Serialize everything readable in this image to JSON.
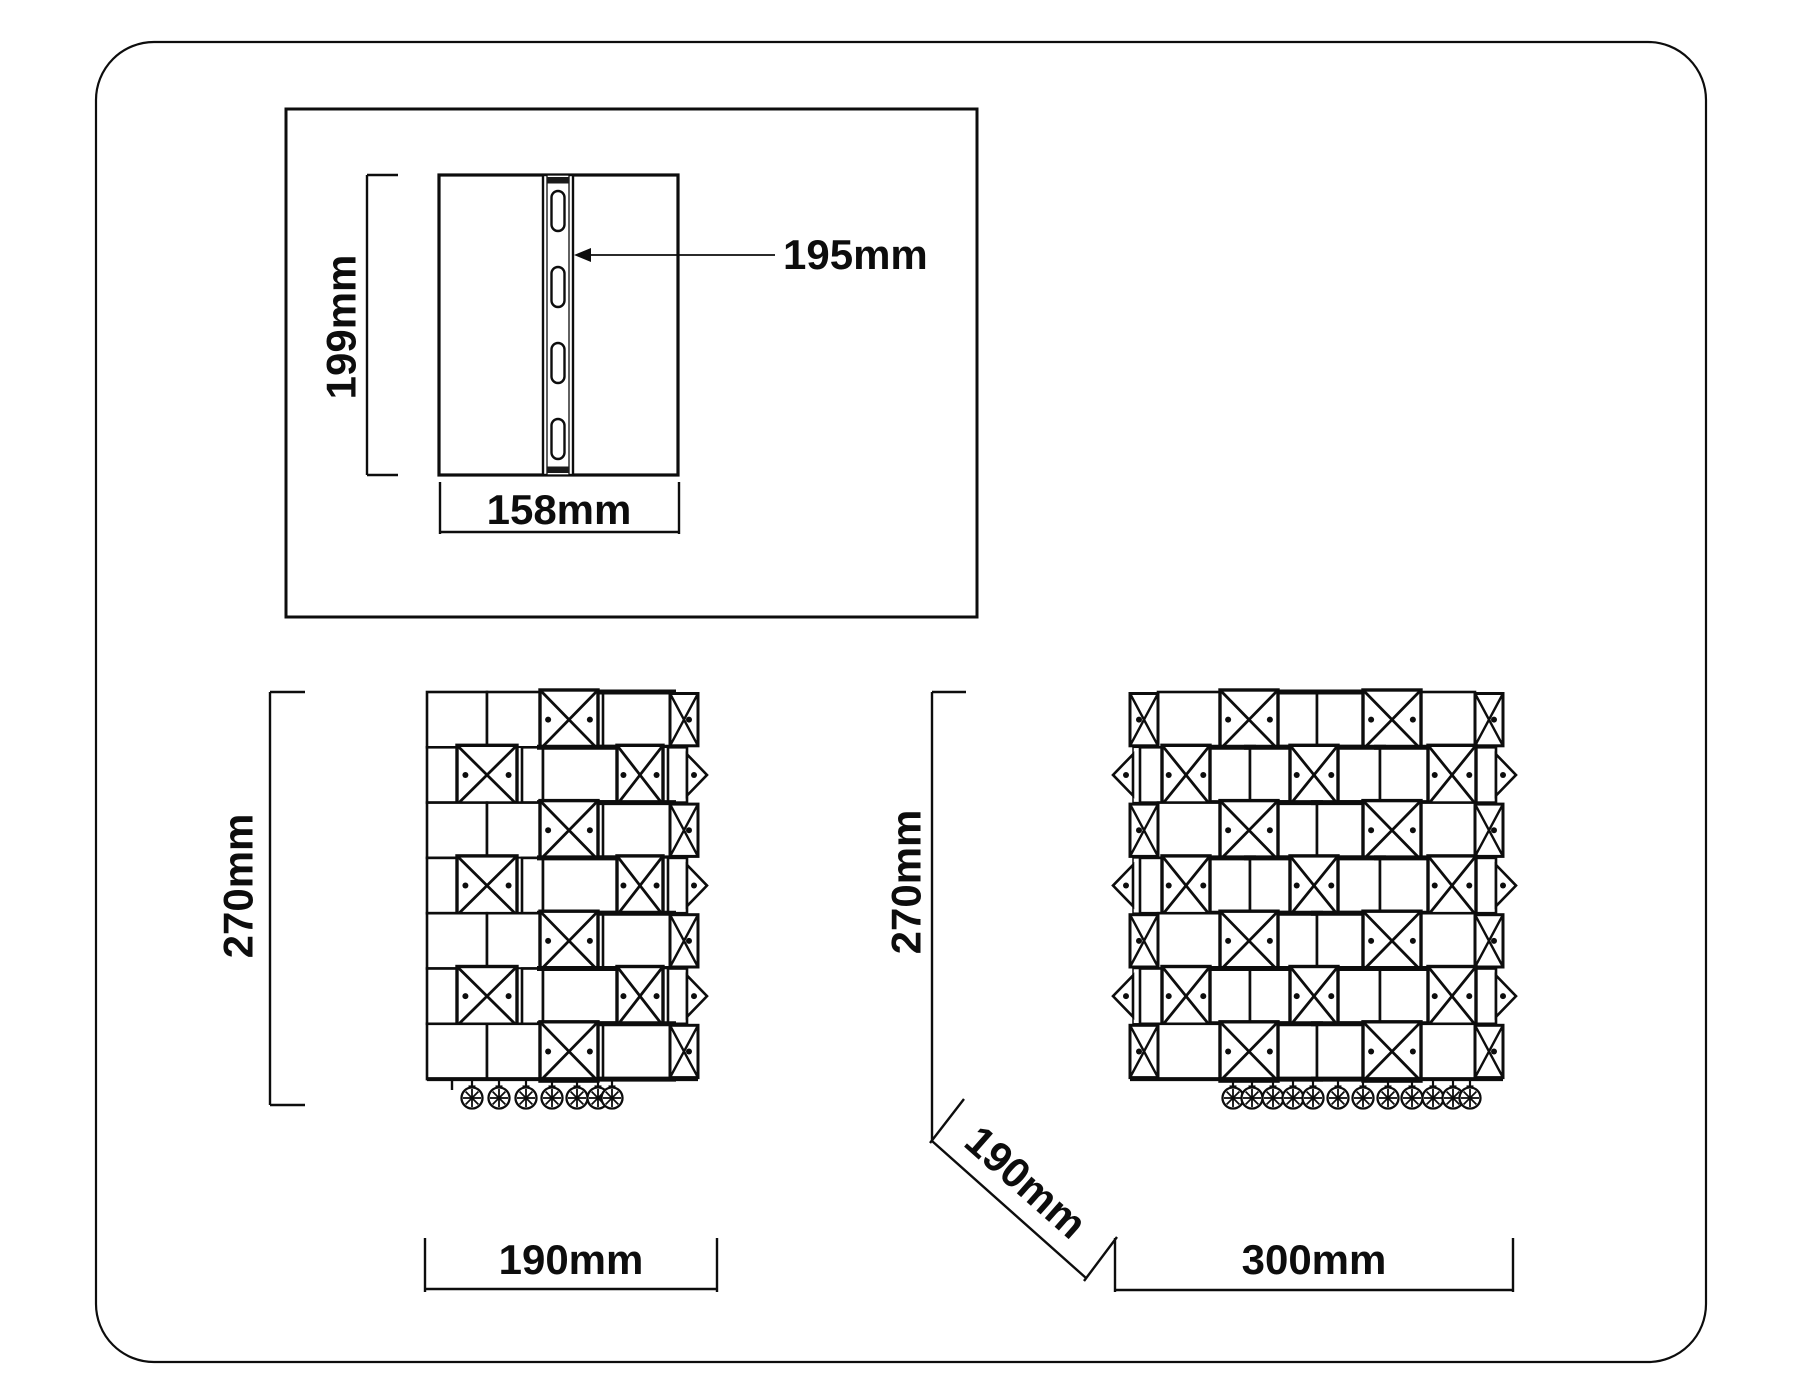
{
  "colors": {
    "ink": "#0d0d0d",
    "background": "#ffffff"
  },
  "plate_view": {
    "height_label": "199mm",
    "width_label": "158mm",
    "rail_label": "195mm",
    "slot_count": 4
  },
  "front_view": {
    "height_label": "270mm",
    "width_label": "190mm",
    "row_count": 7,
    "crystal_count": 7
  },
  "side_view": {
    "height_label": "270mm",
    "width_label": "300mm",
    "depth_label": "190mm",
    "row_count": 7,
    "crystal_count": 12
  }
}
